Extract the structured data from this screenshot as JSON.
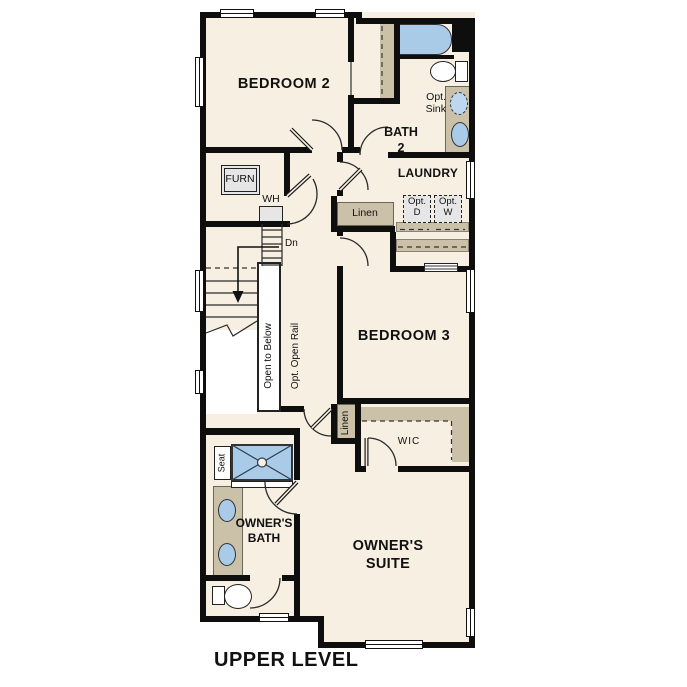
{
  "title": {
    "text": "UPPER LEVEL"
  },
  "rooms": {
    "bedroom2": "BEDROOM 2",
    "bath2_line1": "BATH",
    "bath2_line2": "2",
    "laundry": "LAUNDRY",
    "bedroom3": "BEDROOM 3",
    "wic": "WIC",
    "owners_bath_line1": "OWNER'S",
    "owners_bath_line2": "BATH",
    "owners_suite_line1": "OWNER'S",
    "owners_suite_line2": "SUITE"
  },
  "fixtures": {
    "furnace": "FURN",
    "water_heater": "WH",
    "stairs_down": "Dn",
    "linen_hall": "Linen",
    "linen_owner": "Linen",
    "opt_sink_line1": "Opt.",
    "opt_sink_line2": "Sink",
    "opt_dryer_line1": "Opt.",
    "opt_dryer_line2": "D",
    "opt_washer_line1": "Opt.",
    "opt_washer_line2": "W",
    "open_to_below": "Open to Below",
    "opt_open_rail": "Opt. Open Rail",
    "seat": "Seat"
  },
  "colors": {
    "wall": "#0e0e0e",
    "floor": "#f6efe2",
    "casework_tan": "#cbc1a9",
    "fixture_blue": "#a9cbe8",
    "appliance_gray": "#e6e6e6",
    "background": "#ffffff"
  }
}
